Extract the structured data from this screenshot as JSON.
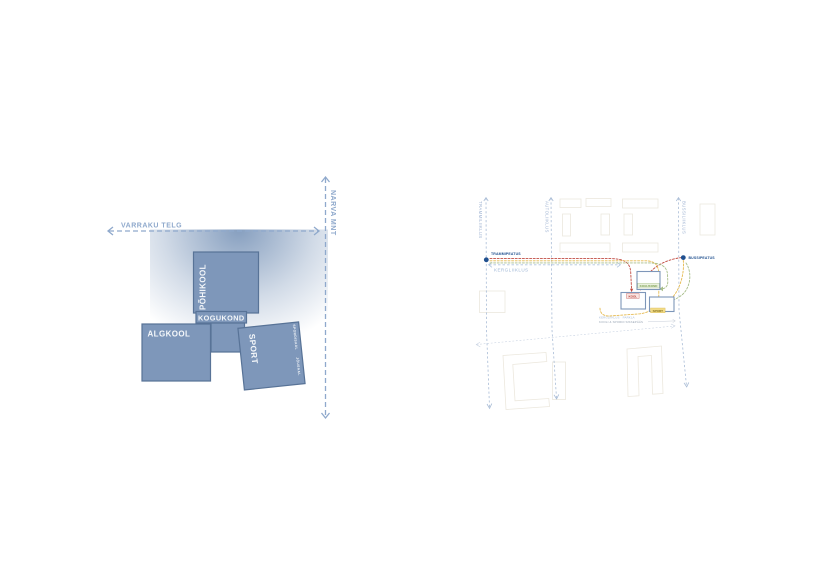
{
  "concept_diagram": {
    "axes": {
      "horizontal_label": "VARRAKU TELG",
      "vertical_label": "NARVA MNT"
    },
    "blocks": {
      "pohikool": "PÕHIKOOL",
      "kogukond": "KOGUKOND",
      "algkool": "ALGKOOL",
      "sport": "SPORT",
      "sport_edge_label_top": "SPORDISAAL",
      "sport_edge_label_bottom": "JÕUSAAL"
    },
    "colors": {
      "block_fill": "#7E97BA",
      "block_border": "#587397",
      "axis_blue": "#8FA9CC",
      "gradient_blue": "#718EB4"
    }
  },
  "site_plan": {
    "streets": [
      {
        "label": "TRAMMILIIKLUS"
      },
      {
        "label": "AUTOLIIKLUS"
      },
      {
        "label": "BUSSILIIKLUS"
      }
    ],
    "stops": [
      {
        "label": "TRAMMIPEATUS"
      },
      {
        "label": "BUSSIPEATUS"
      }
    ],
    "kergliiklus_label": "KERGLIIKLUS",
    "school": {
      "kool": "KOOL",
      "kogukond": "KOGUKOND",
      "sport": "SPORT"
    },
    "notes": {
      "line1": "KERGLIIKLUS · PARKLA",
      "line2": "KOOLI & SPORDI SISSEPÄÄS"
    },
    "colors": {
      "route_red": "#C14B42",
      "route_yellow": "#E5B94E",
      "route_green": "#A8BE8A",
      "stop_dot": "#20508F",
      "street_dash": "#A9BCD6",
      "building_outline": "#ECE8DE",
      "school_box_border": "#7D96B9"
    }
  }
}
